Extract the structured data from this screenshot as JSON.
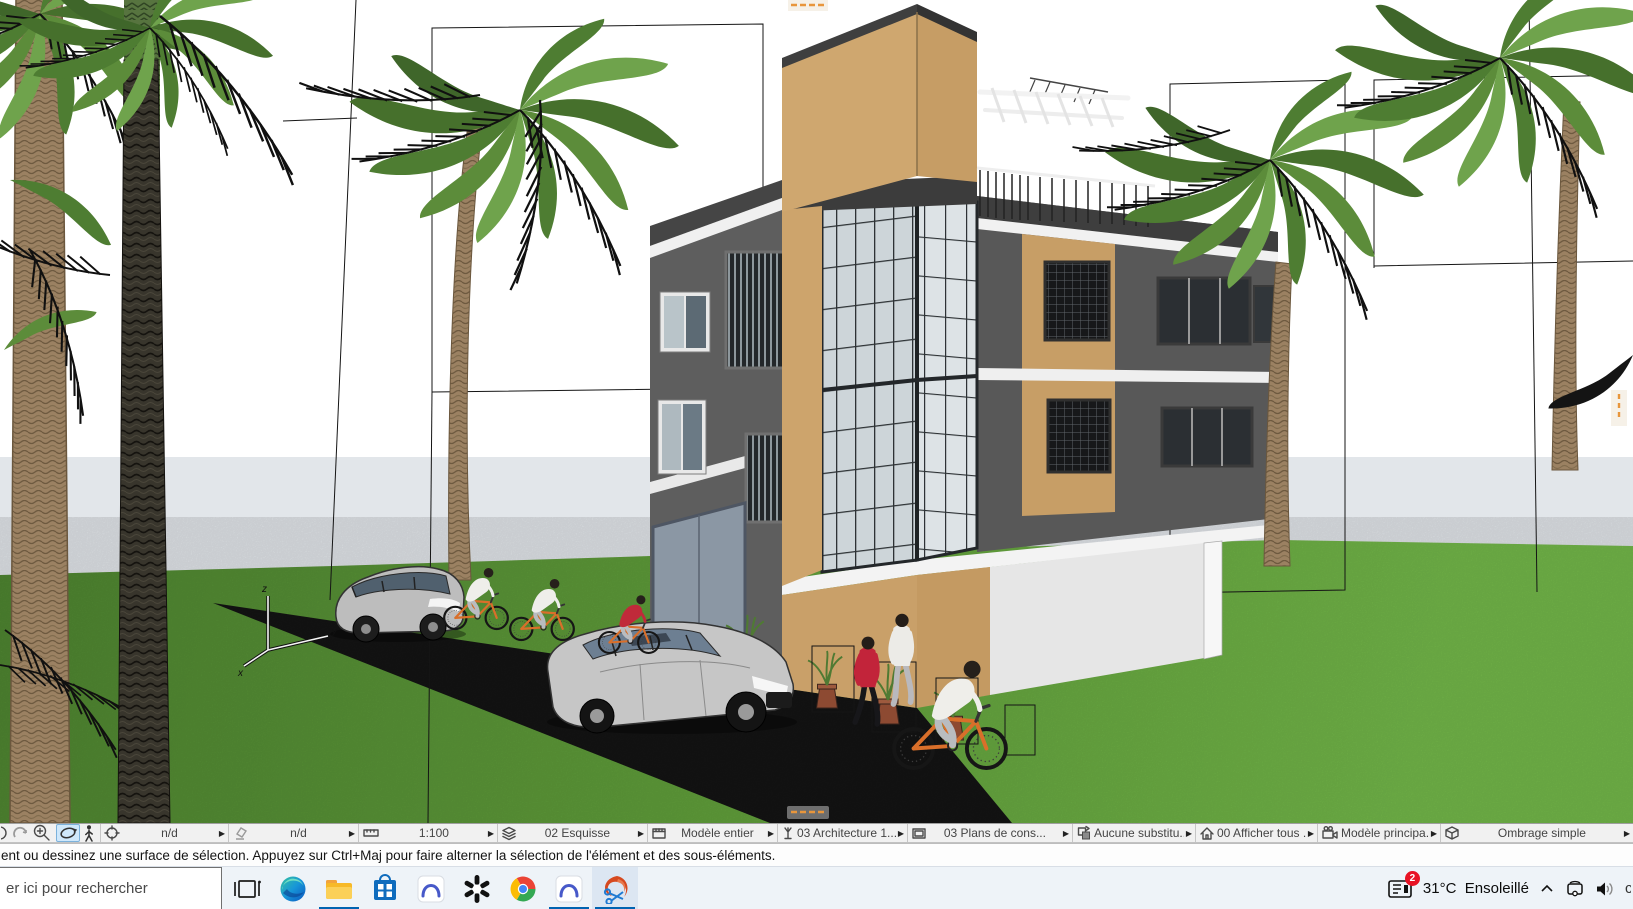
{
  "app": {
    "title": "ArchiCAD — Vue 3D"
  },
  "scene": {
    "axis": {
      "x": "x",
      "y": "y",
      "z": "z"
    },
    "palette": {
      "sky": "#ffffff",
      "horizon": "#e2e6ea",
      "grassDark": "#4f8631",
      "grassMid": "#63a23c",
      "grassLight": "#74b94a",
      "road": "#141414",
      "towerLeft": "#cfa76f",
      "towerRight": "#c69d65",
      "wallDark": "#5e5e5e",
      "wallDark2": "#585858",
      "roofTrim": "#3f3f3f",
      "fascia": "#f1f1f1",
      "tan": "#c9a069",
      "glassLeft": "#cdd5d9",
      "glassRight": "#dde3e6",
      "mullion": "#2c3134",
      "garage": "#8b97a4",
      "ground": "#e6e6e6",
      "barkLight": "#9b8162",
      "barkDark": "#38352c",
      "frondGreen": "#4e7d32",
      "frondLight": "#6fa34c",
      "bikeOrange": "#d96f2a",
      "carSilver": "#c3c3c3",
      "accentRed": "#c02a3a",
      "sectionOrange": "#e8963c"
    }
  },
  "quick_options_bar": {
    "tools": [
      {
        "name": "zoom-previous"
      },
      {
        "name": "zoom-in"
      },
      {
        "name": "orbit",
        "active": true
      },
      {
        "name": "explore"
      }
    ],
    "segments": [
      {
        "name": "fit-in-window",
        "label": "n/d"
      },
      {
        "name": "override",
        "label": "n/d"
      },
      {
        "name": "scale",
        "label": "1:100"
      },
      {
        "name": "layer-combination",
        "label": "02 Esquisse"
      },
      {
        "name": "model-view-options",
        "label": "Modèle entier"
      },
      {
        "name": "floor-plan-cut",
        "label": "03 Architecture 1..."
      },
      {
        "name": "pen-set",
        "label": "03 Plans de cons..."
      },
      {
        "name": "graphic-override",
        "label": "Aucune substitu..."
      },
      {
        "name": "renovation-filter",
        "label": "00 Afficher tous ..."
      },
      {
        "name": "camera-set",
        "label": "Modèle principa..."
      },
      {
        "name": "render-style",
        "label": "Ombrage simple"
      }
    ]
  },
  "status_bar": {
    "message": "ent ou dessinez une surface de sélection. Appuyez sur Ctrl+Maj pour faire alterner la sélection de l'élément et des sous-éléments."
  },
  "taskbar": {
    "search": {
      "placeholder": "er ici pour rechercher"
    },
    "apps": [
      {
        "name": "task-view"
      },
      {
        "name": "edge"
      },
      {
        "name": "file-explorer",
        "active": true
      },
      {
        "name": "microsoft-store"
      },
      {
        "name": "app-arc"
      },
      {
        "name": "chatgpt"
      },
      {
        "name": "chrome"
      },
      {
        "name": "app-arc-2",
        "active": true
      },
      {
        "name": "archicad",
        "active": true,
        "focused": true
      }
    ],
    "tray": {
      "notification_count": "2",
      "temperature": "31°C",
      "weather": "Ensoleillé",
      "partial_glyph": "c"
    }
  }
}
